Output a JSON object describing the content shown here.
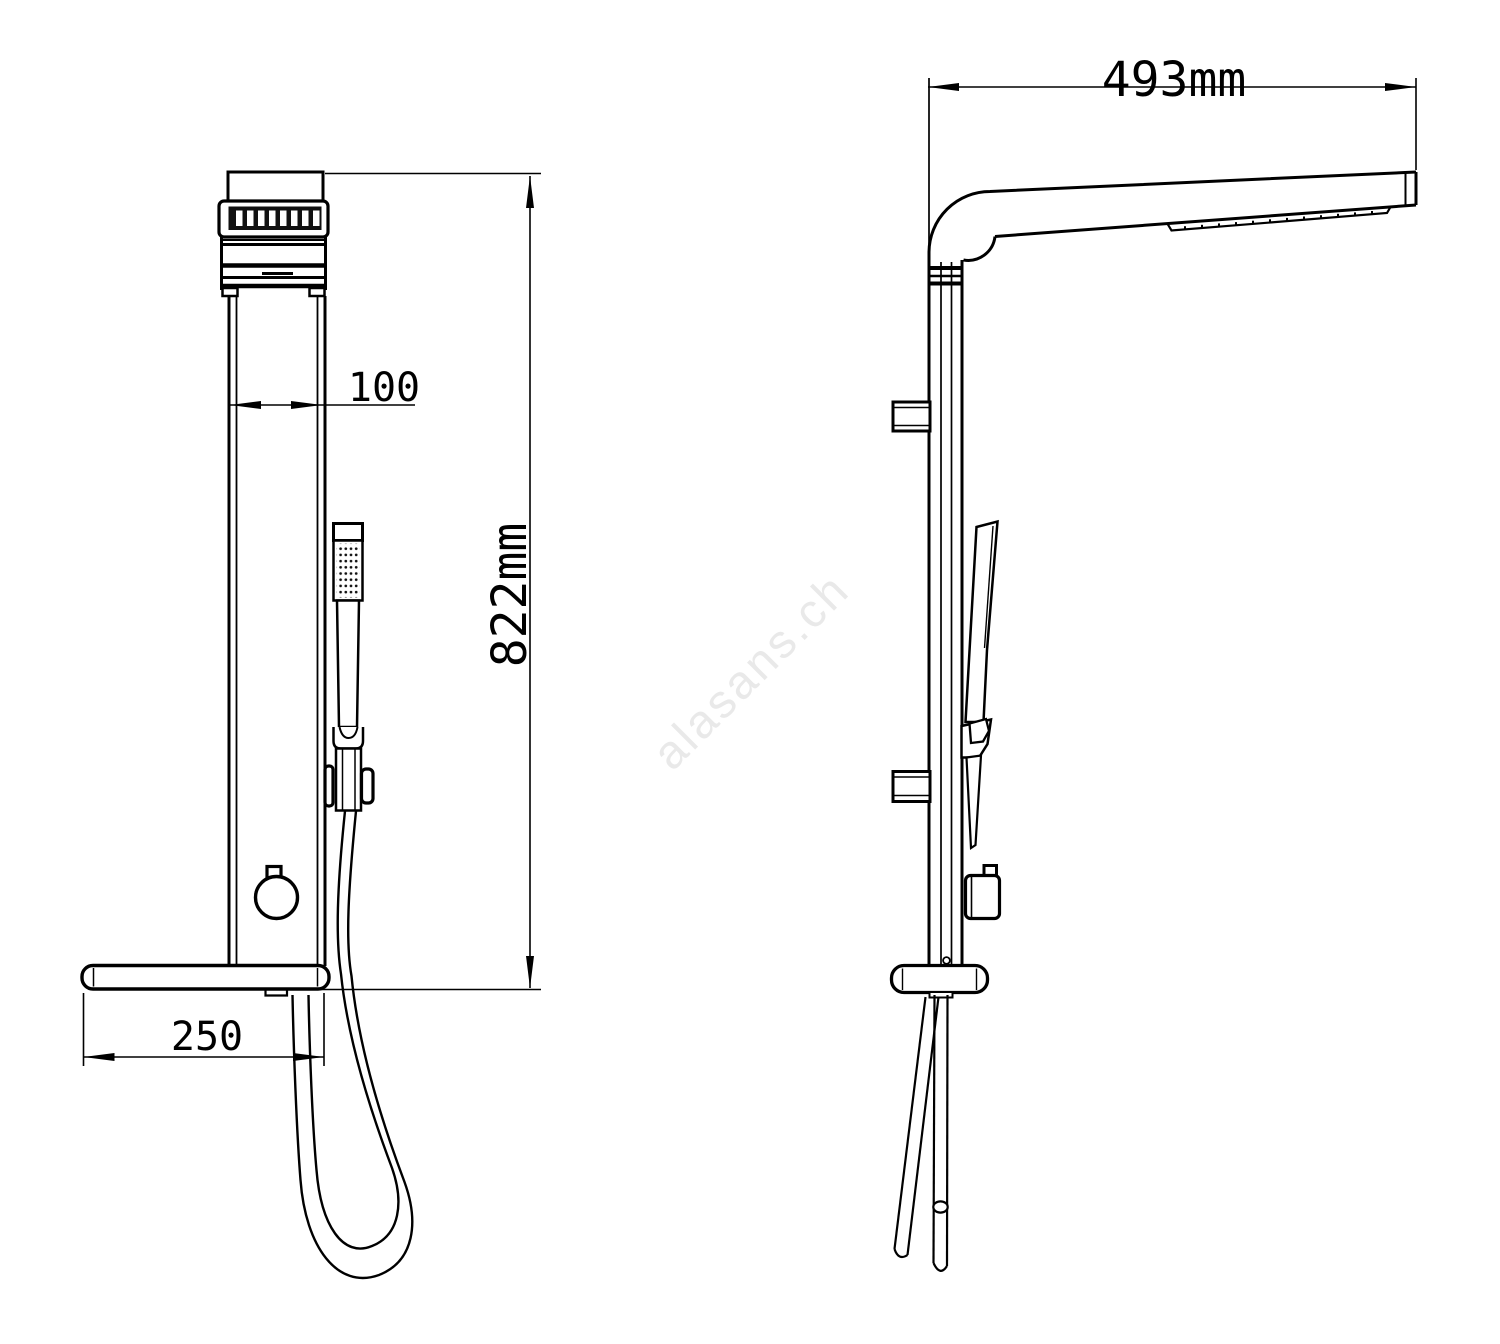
{
  "document": {
    "type": "technical-drawing",
    "background": "#ffffff",
    "line_color": "#000000"
  },
  "watermark": {
    "text": "alasans.ch",
    "color": "#e9e9e9"
  },
  "front_view": {
    "dimensions": {
      "panel_width": "100",
      "total_height": "822mm",
      "shelf_depth": "250"
    }
  },
  "side_view": {
    "dimensions": {
      "arm_length": "493mm"
    }
  }
}
